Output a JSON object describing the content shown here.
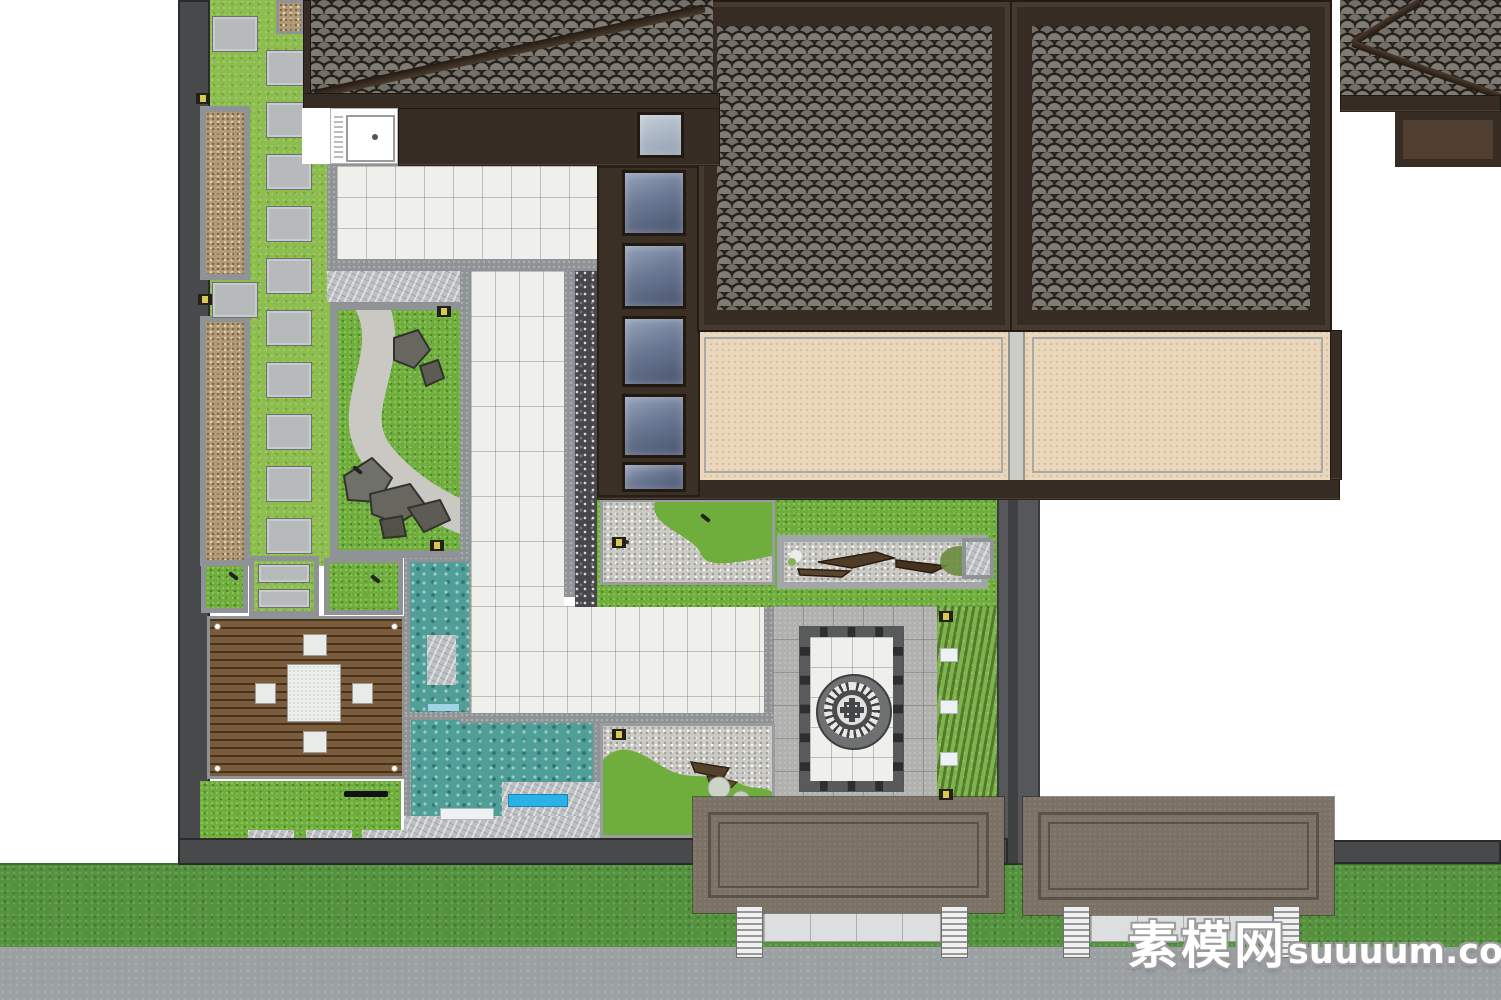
{
  "meta": {
    "title": "Chinese courtyard residence landscape site plan (top-down render)",
    "render_type": "3D model plan view"
  },
  "watermark": {
    "cn": "素模网",
    "latin": "suuuum.com"
  },
  "palette": {
    "page_bg": "#ffffff",
    "wall_dark": "#48494b",
    "wall_mid": "#7c8082",
    "border_gray": "#8f9395",
    "lime_lawn": "#8cbd4e",
    "lawn_green": "#6fae3c",
    "olive_shrub": "#7cb34c",
    "verge_green": "#55923e",
    "road_gray": "#9ba0a3",
    "paver_gray": "#b7babb",
    "concrete_gray": "#b1b1af",
    "white_tile": "#efefec",
    "marble_gray": "#bdc0c2",
    "gravel_brown": "#b39b77",
    "gravel_white": "#cbcac5",
    "pebble_dark": "#47474a",
    "roof_frame": "#372c23",
    "roof_tile": "#6f6c66",
    "wall_brown": "#3a3026",
    "tan_floor": "#ead7bc",
    "water_teal": "#4f9e97",
    "slide_blue": "#2ab2e8",
    "deck_wood": "#7b5c3a",
    "gate_roof": "#7b7164",
    "gate_line": "#5b5349",
    "frame_black": "#2c2e30",
    "lamp_yellow": "#d9c94c"
  },
  "features": [
    {
      "id": "main-residence-roof",
      "label": "Grey fish-scale tiled hip roofs of main residence"
    },
    {
      "id": "veranda-floor",
      "label": "Tan interior floor panels under eaves"
    },
    {
      "id": "entry-courtyard",
      "label": "Entry court with black-framed panel and circular coin-motif paving"
    },
    {
      "id": "entry-gates",
      "label": "Two flat-roofed entry gate canopies over street columns"
    },
    {
      "id": "wood-deck",
      "label": "Timber deck with square tea table and four stools"
    },
    {
      "id": "water-features",
      "label": "Two turquoise pools with stone ledges and blue spout"
    },
    {
      "id": "rock-garden",
      "label": "Lawn panel with winding gravel path and rockery stones"
    },
    {
      "id": "side-yard",
      "label": "Side yard strip with stepping stones and pebble planters"
    },
    {
      "id": "skylight-windows",
      "label": "Column of sky-reflecting windows along inner wall"
    },
    {
      "id": "street",
      "label": "Grey street with green lawn verge"
    }
  ],
  "scene": {
    "stone_size": [
      46,
      36
    ],
    "stepping_stones": [
      [
        212,
        16
      ],
      [
        212,
        282
      ],
      [
        266,
        50
      ],
      [
        266,
        102
      ],
      [
        266,
        154
      ],
      [
        266,
        206
      ],
      [
        266,
        258
      ],
      [
        266,
        310
      ],
      [
        266,
        362
      ],
      [
        266,
        414
      ],
      [
        266,
        466
      ],
      [
        266,
        518
      ]
    ],
    "windows_wall": {
      "x_rel": 25,
      "w": 64,
      "items": [
        [
          4,
          66
        ],
        [
          77,
          66
        ],
        [
          150,
          71
        ],
        [
          228,
          64
        ],
        [
          296,
          30
        ]
      ]
    },
    "garden_lamps": [
      [
        196,
        93
      ],
      [
        198,
        294
      ],
      [
        437,
        306
      ],
      [
        430,
        540
      ],
      [
        612,
        537
      ],
      [
        612,
        729
      ],
      [
        939,
        611
      ],
      [
        939,
        789
      ]
    ],
    "shrub_stones": [
      [
        940,
        648
      ],
      [
        940,
        700
      ],
      [
        940,
        752
      ]
    ],
    "gate_columns": [
      [
        736,
        906
      ],
      [
        941,
        906
      ],
      [
        1063,
        906
      ],
      [
        1273,
        906
      ]
    ],
    "column_size": [
      27,
      52
    ],
    "lime_sq_pavers": [
      [
        258,
        564
      ],
      [
        258,
        589
      ]
    ],
    "deck_lawn_pavers": [
      [
        248,
        830
      ],
      [
        306,
        830
      ],
      [
        362,
        830
      ]
    ],
    "plant_markers": [
      [
        228,
        574
      ],
      [
        370,
        577
      ],
      [
        352,
        468
      ],
      [
        700,
        516
      ]
    ]
  }
}
